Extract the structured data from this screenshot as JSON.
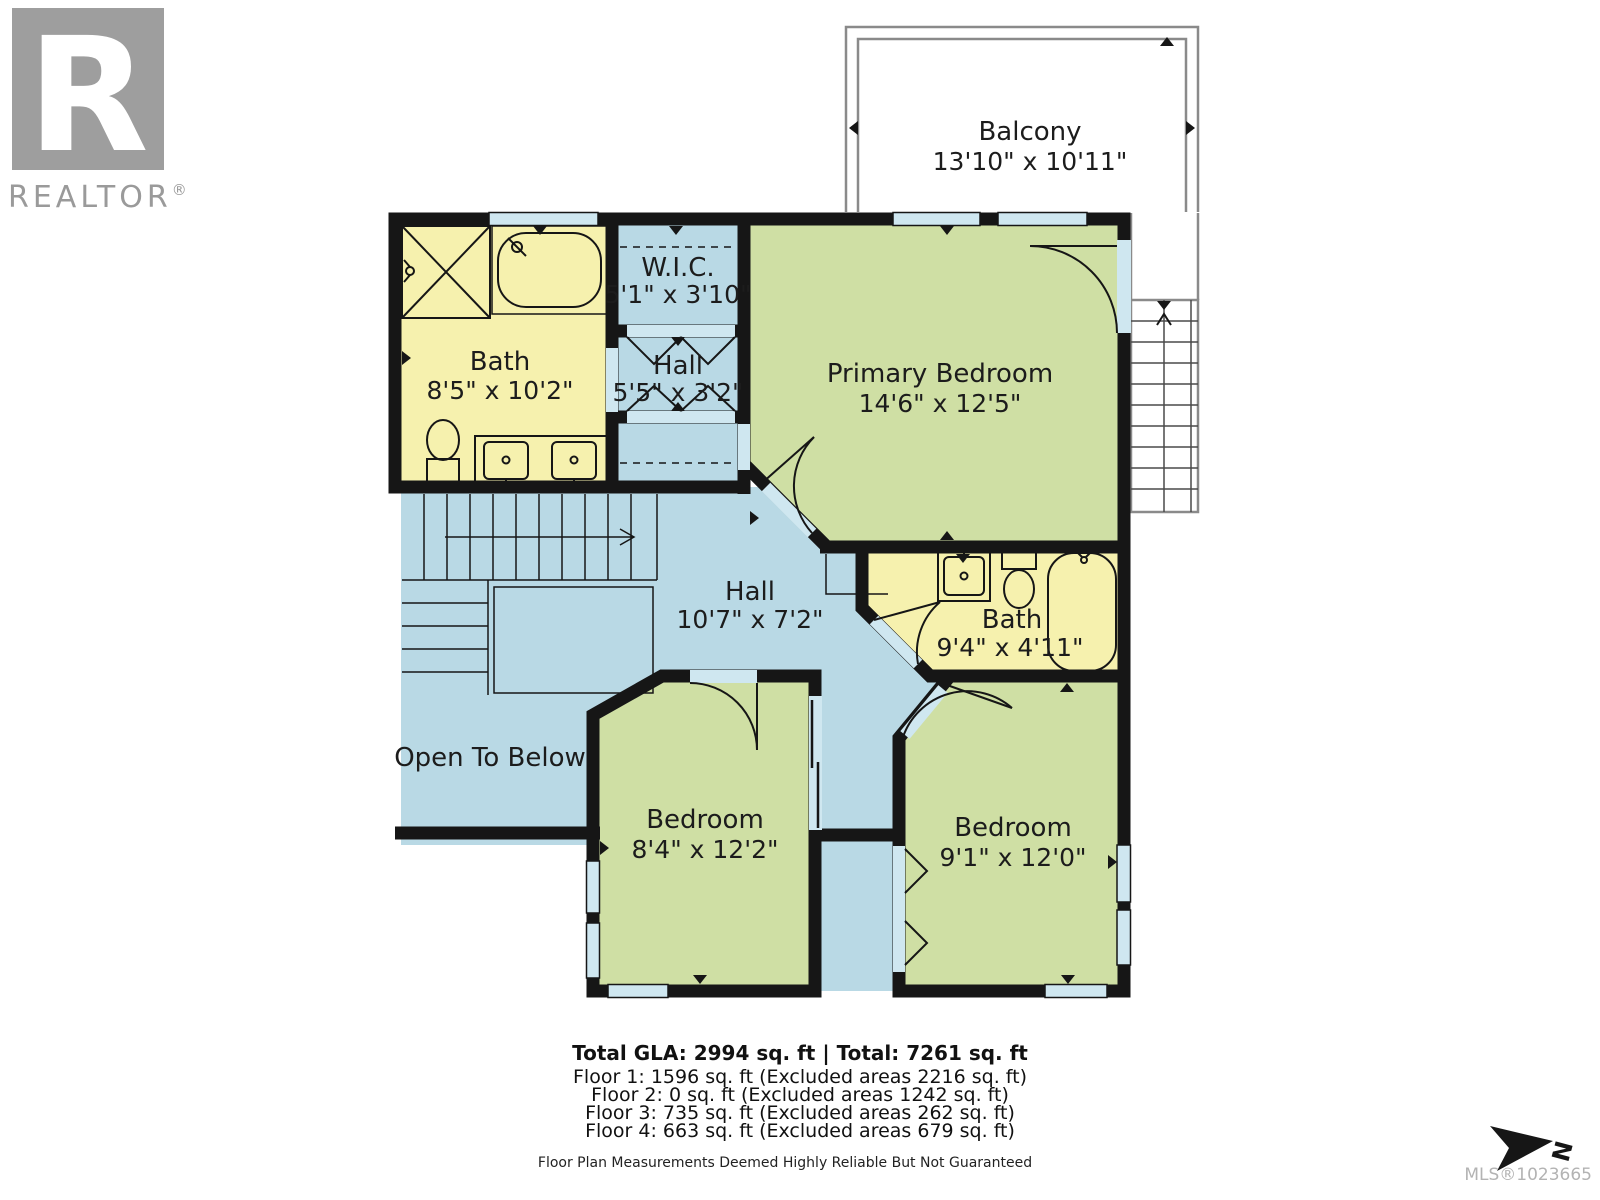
{
  "colors": {
    "wall": "#161616",
    "room_yellow": "#f6f1ae",
    "room_green": "#cfdfa4",
    "room_blue": "#b9d9e5",
    "window_blue": "#cfe7f0",
    "outline_grey": "#8a8a8a",
    "logo_grey": "#9e9e9e"
  },
  "logo": {
    "letter": "R",
    "brand": "REALTOR",
    "reg": "®"
  },
  "rooms": {
    "balcony": {
      "name": "Balcony",
      "dims": "13'10\" x 10'11\""
    },
    "bath_upper": {
      "name": "Bath",
      "dims": "8'5\" x 10'2\""
    },
    "wic": {
      "name": "W.I.C.",
      "dims": "5'1\" x 3'10\""
    },
    "hall_small": {
      "name": "Hall",
      "dims": "5'5\" x 3'2\""
    },
    "primary_bedroom": {
      "name": "Primary Bedroom",
      "dims": "14'6\" x 12'5\""
    },
    "hall_main": {
      "name": "Hall",
      "dims": "10'7\" x 7'2\""
    },
    "bath_lower": {
      "name": "Bath",
      "dims": "9'4\" x 4'11\""
    },
    "open_to_below": {
      "name": "Open To Below"
    },
    "bedroom_left": {
      "name": "Bedroom",
      "dims": "8'4\" x 12'2\""
    },
    "bedroom_right": {
      "name": "Bedroom",
      "dims": "9'1\" x 12'0\""
    }
  },
  "footer": {
    "totals": "Total GLA: 2994 sq. ft | Total: 7261 sq. ft",
    "floors": [
      "Floor 1: 1596 sq. ft (Excluded areas 2216 sq. ft)",
      "Floor 2: 0 sq. ft (Excluded areas 1242 sq. ft)",
      "Floor 3: 735 sq. ft (Excluded areas 262 sq. ft)",
      "Floor 4: 663 sq. ft (Excluded areas 679 sq. ft)"
    ],
    "disclaimer": "Floor Plan Measurements Deemed Highly Reliable But Not Guaranteed"
  },
  "mls": "MLS®1023665",
  "compass": {
    "label": "N"
  }
}
